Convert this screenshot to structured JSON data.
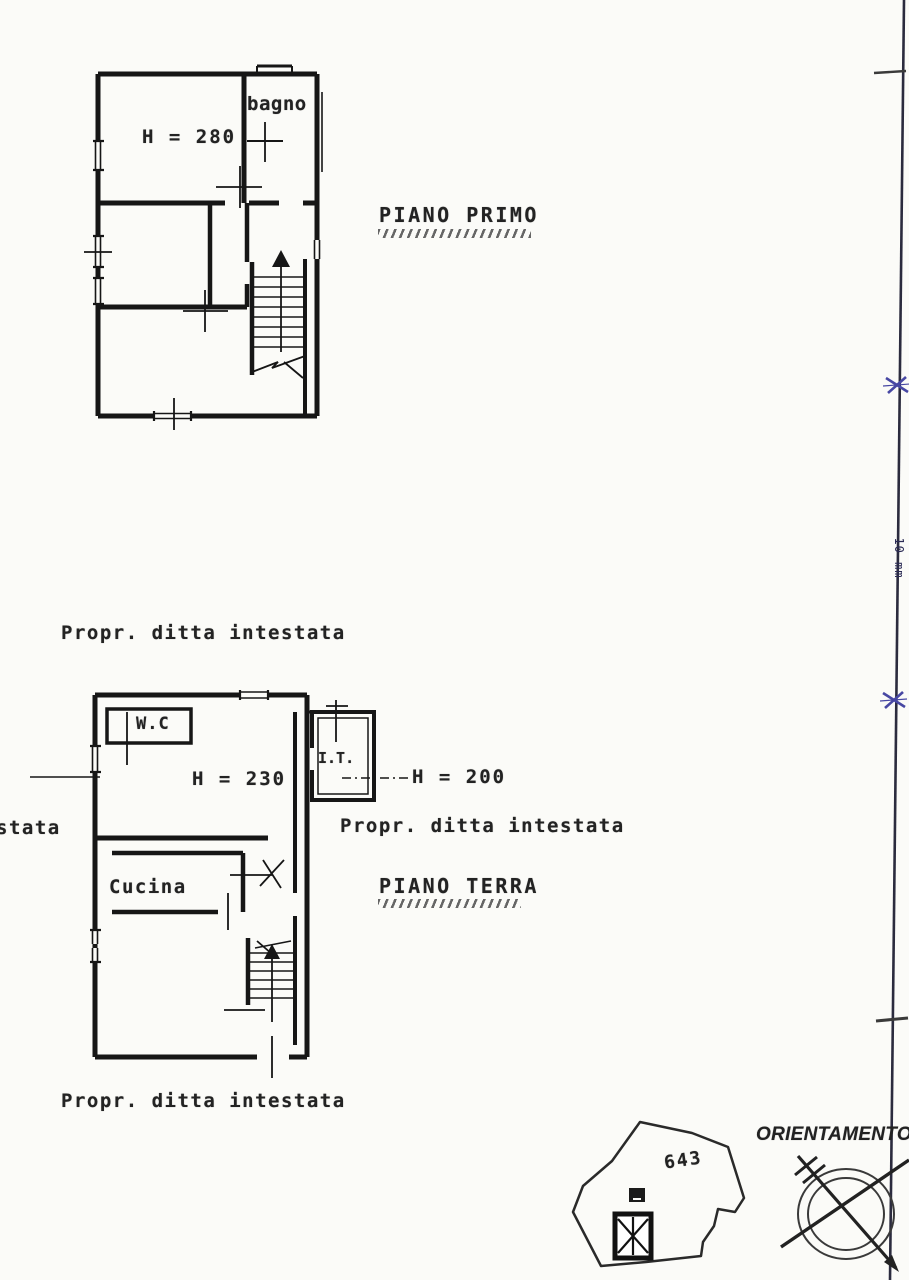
{
  "labels": {
    "piano_primo": "PIANO PRIMO",
    "piano_terra": "PIANO TERRA",
    "owner_top": "Propr. ditta intestata",
    "owner_mid": "Propr. ditta intestata",
    "owner_bottom": "Propr. ditta intestata",
    "owner_left_cut": "stata",
    "orientamento": "ORIENTAMENTO",
    "margin_note": "10 mm"
  },
  "first_floor": {
    "height": "H = 280",
    "bagno": "bagno"
  },
  "ground_floor": {
    "height": "H = 230",
    "annex_height": "H = 200",
    "wc": "W.C",
    "cucina": "Cucina",
    "it": "I.T."
  },
  "parcel": {
    "number": "643"
  },
  "colors": {
    "paper": "#fbfbf8",
    "ink": "#1b1b1b",
    "sheet_border": "#2b2b3e",
    "registration_mark": "#4747a3"
  }
}
